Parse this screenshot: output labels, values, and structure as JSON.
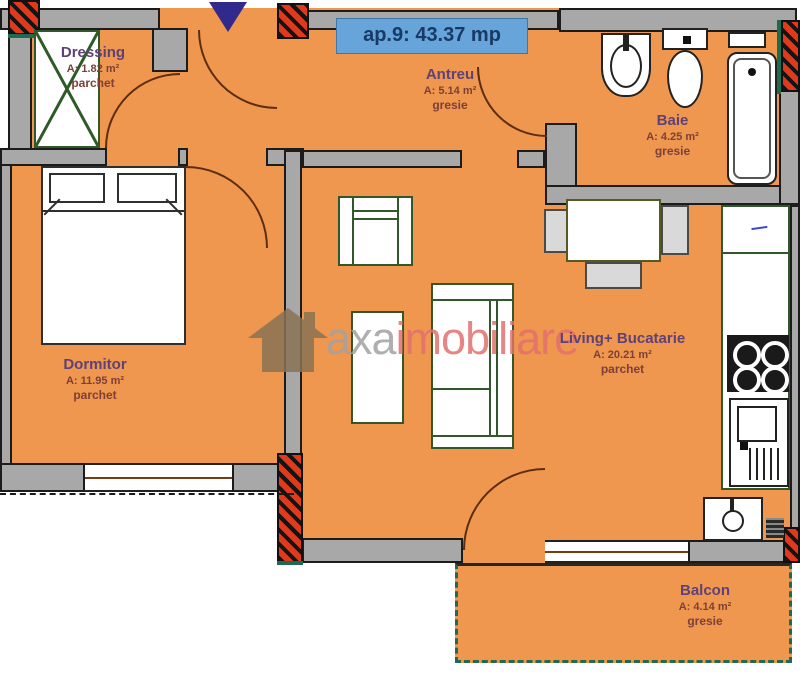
{
  "title_badge": {
    "text": "ap.9: 43.37 mp"
  },
  "entrance": {
    "icon": "entrance-arrow-icon"
  },
  "watermark": {
    "brand_primary": "axa",
    "brand_secondary": "imobiliare"
  },
  "rooms": [
    {
      "id": "dressing",
      "name": "Dressing",
      "area": "A: 1.82 m²",
      "floor": "parchet"
    },
    {
      "id": "antreu",
      "name": "Antreu",
      "area": "A: 5.14 m²",
      "floor": "gresie"
    },
    {
      "id": "baie",
      "name": "Baie",
      "area": "A: 4.25 m²",
      "floor": "gresie"
    },
    {
      "id": "dormitor",
      "name": "Dormitor",
      "area": "A: 11.95 m²",
      "floor": "parchet"
    },
    {
      "id": "living",
      "name": "Living+ Bucatarie",
      "area": "A: 20.21 m²",
      "floor": "parchet"
    },
    {
      "id": "balcon",
      "name": "Balcon",
      "area": "A: 4.14 m²",
      "floor": "gresie"
    }
  ],
  "fixtures": [
    "wardrobe",
    "double-bed",
    "armchair",
    "coffee-table",
    "sofa",
    "dining-table",
    "dining-chairs",
    "kitchen-counter",
    "stove",
    "kitchen-sink",
    "bathroom-sink",
    "toilet",
    "bathtub",
    "boiler",
    "window",
    "door-arc"
  ],
  "colors": {
    "floor_orange": "#ef964f",
    "wall_gray": "#a8a8a8",
    "hatch_red": "#e0391c",
    "balcony_green": "#1e6b4f",
    "title_bg": "#66a4da",
    "title_text": "#173a66",
    "arrow_blue": "#312a8c",
    "room_name_text": "#5e4277",
    "room_detail_text": "#7c4038",
    "furniture_outline": "#30582a",
    "watermark_gray": "#a2a2a2",
    "watermark_red": "#e2706e"
  }
}
